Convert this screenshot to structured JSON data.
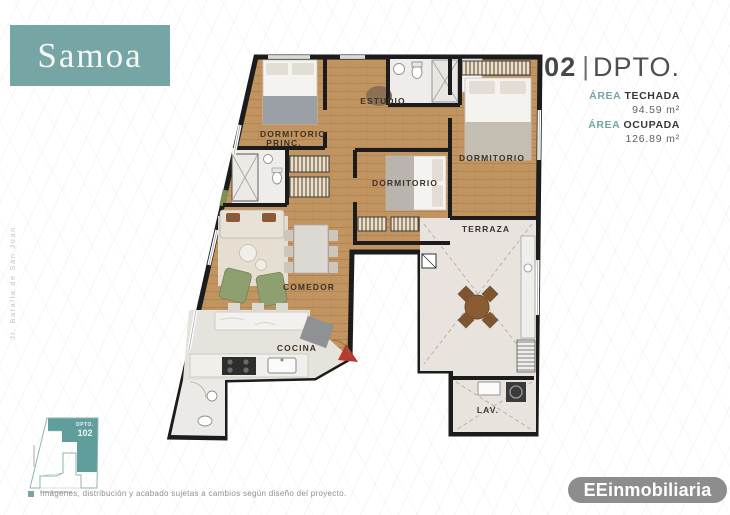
{
  "brand": {
    "name": "Samoa"
  },
  "unit": {
    "number": "102",
    "separator": "|",
    "type": "DPTO."
  },
  "areas": {
    "techada": {
      "accent": "ÁREA",
      "label": "TECHADA",
      "value": "94.59 m²"
    },
    "ocupada": {
      "accent": "ÁREA",
      "label": "OCUPADA",
      "value": "126.89 m²"
    }
  },
  "side_text": "Jr. Batalla de San Juan",
  "plan": {
    "rooms": {
      "dorm_princ_line1": "DORMITORIO",
      "dorm_princ_line2": "PRINC.",
      "estudio": "ESTUDIO",
      "dorm_mid": "DORMITORIO",
      "dorm_right": "DORMITORIO",
      "terraza": "TERRAZA",
      "comedor": "COMEDOR",
      "cocina": "COCINA",
      "lav": "LAV."
    }
  },
  "key_plan": {
    "dpto": "DPTO.",
    "number": "102"
  },
  "footer": {
    "disclaimer": "Imágenes, distribución y acabado sujetas a cambios según diseño del proyecto.",
    "brand": "EEinmobiliaria"
  },
  "colors": {
    "teal": "#76a5a6",
    "keyplan_teal": "#5f9e9b",
    "wall": "#1c1c1c",
    "wood": "#c2945f",
    "tile": "#e8e4dd",
    "logo_gray": "#8d8d8d",
    "entry_red": "#b83a2e"
  }
}
